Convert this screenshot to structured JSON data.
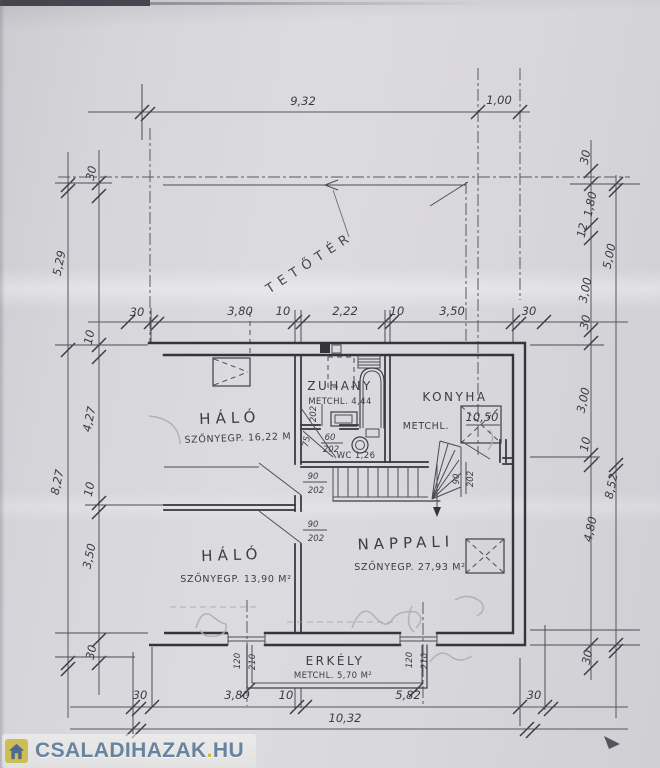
{
  "watermark": {
    "brand": "CSALADIHAZAK",
    "dot": ".",
    "tld": "HU"
  },
  "attic": {
    "label": "TETŐTÉR"
  },
  "rooms": {
    "halo1": {
      "name": "HÁLÓ",
      "detail": "SZŐNYEGP. 16,22 M"
    },
    "zuhany": {
      "name": "ZUHANY",
      "detail": "METCHL. 4,44"
    },
    "konyha": {
      "name": "KONYHA",
      "detail": "METCHL.",
      "area": "10,50"
    },
    "halo2": {
      "name": "HÁLÓ",
      "detail": "SZŐNYEGP. 13,90 M²"
    },
    "nappali": {
      "name": "NAPPALI",
      "detail": "SZŐNYEGP. 27,93 M²"
    },
    "erkely": {
      "name": "ERKÉLY",
      "detail": "METCHL. 5,70 M²"
    },
    "wc": {
      "label": "WC 1,26"
    }
  },
  "doors": {
    "upper_hall": {
      "w": "90",
      "h": "202"
    },
    "lower_hall": {
      "w": "90",
      "h": "202"
    },
    "konyha": {
      "w": "90",
      "h": "202"
    },
    "wc_lobby": {
      "w": "60",
      "h": "202"
    },
    "zuhany_h": "202",
    "lobby_w": "75",
    "balcony_left": {
      "w": "120",
      "h": "210"
    },
    "balcony_right": {
      "w": "120",
      "h": "210"
    }
  },
  "dims": {
    "top_main": "9,32",
    "top_overhang": "1,00",
    "mid": [
      "30",
      "3,80",
      "10",
      "2,22",
      "10",
      "3,50",
      "30"
    ],
    "bottom": [
      "30",
      "3,80",
      "10",
      "5,82",
      "30"
    ],
    "bottom_total": "10,32",
    "left_outer": [
      "5,29",
      "8,27"
    ],
    "left_inner": [
      "30",
      "10",
      "4,27",
      "10",
      "3,50",
      "30"
    ],
    "right_inner": [
      "30",
      "1,80",
      "12",
      "3,00",
      "30",
      "3,00",
      "10",
      "4,80",
      "30"
    ],
    "right_outer": [
      "5,00",
      "8,52"
    ]
  },
  "colors": {
    "ink": "#3e3e47",
    "wall": "#34343d",
    "construction": "#585862",
    "pencil": "#b2ada5",
    "paper": "#d8d7db",
    "brand_blue": "#67839f",
    "brand_gold": "#d2b63e"
  }
}
